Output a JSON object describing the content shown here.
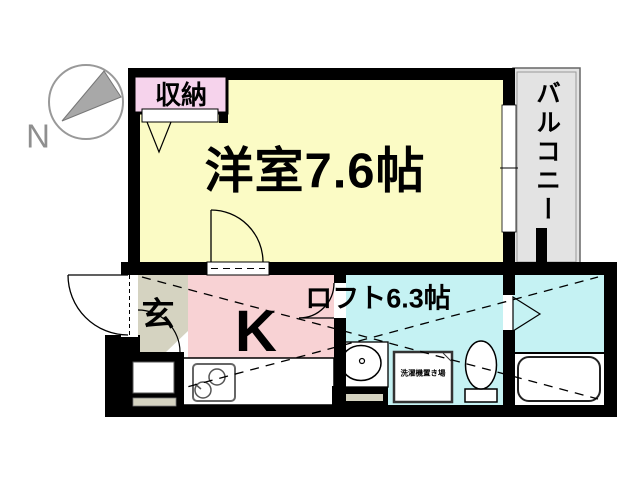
{
  "compass": {
    "north_label": "N"
  },
  "rooms": {
    "main_room": {
      "label": "洋室7.6帖"
    },
    "storage": {
      "label": "収納"
    },
    "balcony": {
      "label": "バルコニー"
    },
    "entrance": {
      "label": "玄"
    },
    "kitchen": {
      "label": "K"
    },
    "loft": {
      "label": "ロフト6.3帖"
    },
    "washer_place": {
      "label": "洗濯機置き場"
    }
  },
  "colors": {
    "wall": "#000000",
    "main_room": "#FBFBC5",
    "storage": "#F6D3EC",
    "balcony": "#E3E3E3",
    "entrance": "#D5D3C1",
    "kitchen": "#F8D2D4",
    "bathroom": "#C5F2F3",
    "fixture": "#FFFFFF",
    "compass_needle": "#A8A8A8"
  }
}
